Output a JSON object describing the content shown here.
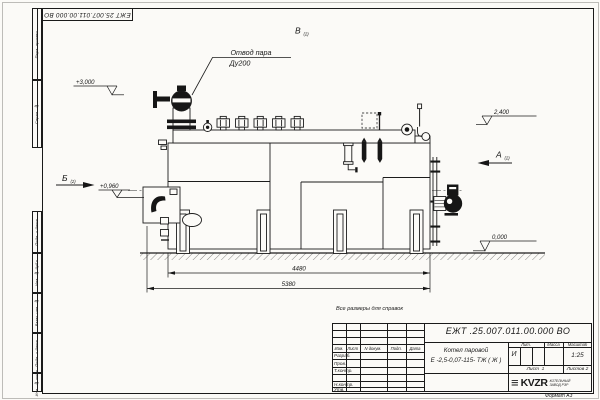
{
  "sheet": {
    "top_doc_number": "ЕЖТ 25.007.011.00.000  ВО",
    "format_label": "Формат А3",
    "stamps_top": [
      "Перв. примен.",
      "Справ. №"
    ],
    "stamps_bottom": [
      "Подп. и дата",
      "Инв. № дубл.",
      "Взам. инв. №",
      "Подп. и дата",
      "Инв. № подл."
    ]
  },
  "drawing": {
    "note": "Все размеры для справок",
    "callout_line1": "Отвод пара",
    "callout_line2": "Ду200",
    "views": [
      {
        "label": "Б",
        "sub": "(2)"
      },
      {
        "label": "А",
        "sub": "(2)"
      },
      {
        "label": "В",
        "sub": "(2)"
      }
    ],
    "elevations": {
      "steam_outlet": "+3,000",
      "burner_axis": "+0,960",
      "drum_top": "2,400",
      "floor": "0,000"
    },
    "dim_inner": "4480",
    "dim_overall": "5380"
  },
  "title_block": {
    "doc_number": "ЕЖТ .25.007.011.00.000  ВО",
    "product_line1": "Котел паровой",
    "product_line2": "Е -2,5-0,07-115- ТЖ ( Ж )",
    "col_headers": [
      "Изм.",
      "Лист",
      "N докум.",
      "Подп.",
      "Дата"
    ],
    "roles": [
      "Разраб.",
      "Пров.",
      "Т.контр.",
      "Н.контр.",
      "Утв."
    ],
    "lit_header": "Лит.",
    "mass_header": "Масса",
    "scale_header": "Масштаб",
    "lit_value": "И",
    "scale_value": "1:25",
    "sheet_label": "Лист",
    "sheet_value": "1",
    "sheets_label": "Листов",
    "sheets_value": "2",
    "logo_bars_glyph": "≡",
    "logo_name": "KVZR",
    "logo_sub1": "КОТЕЛЬНЫЙ",
    "logo_sub2": "ЗАВОД РЭР"
  }
}
